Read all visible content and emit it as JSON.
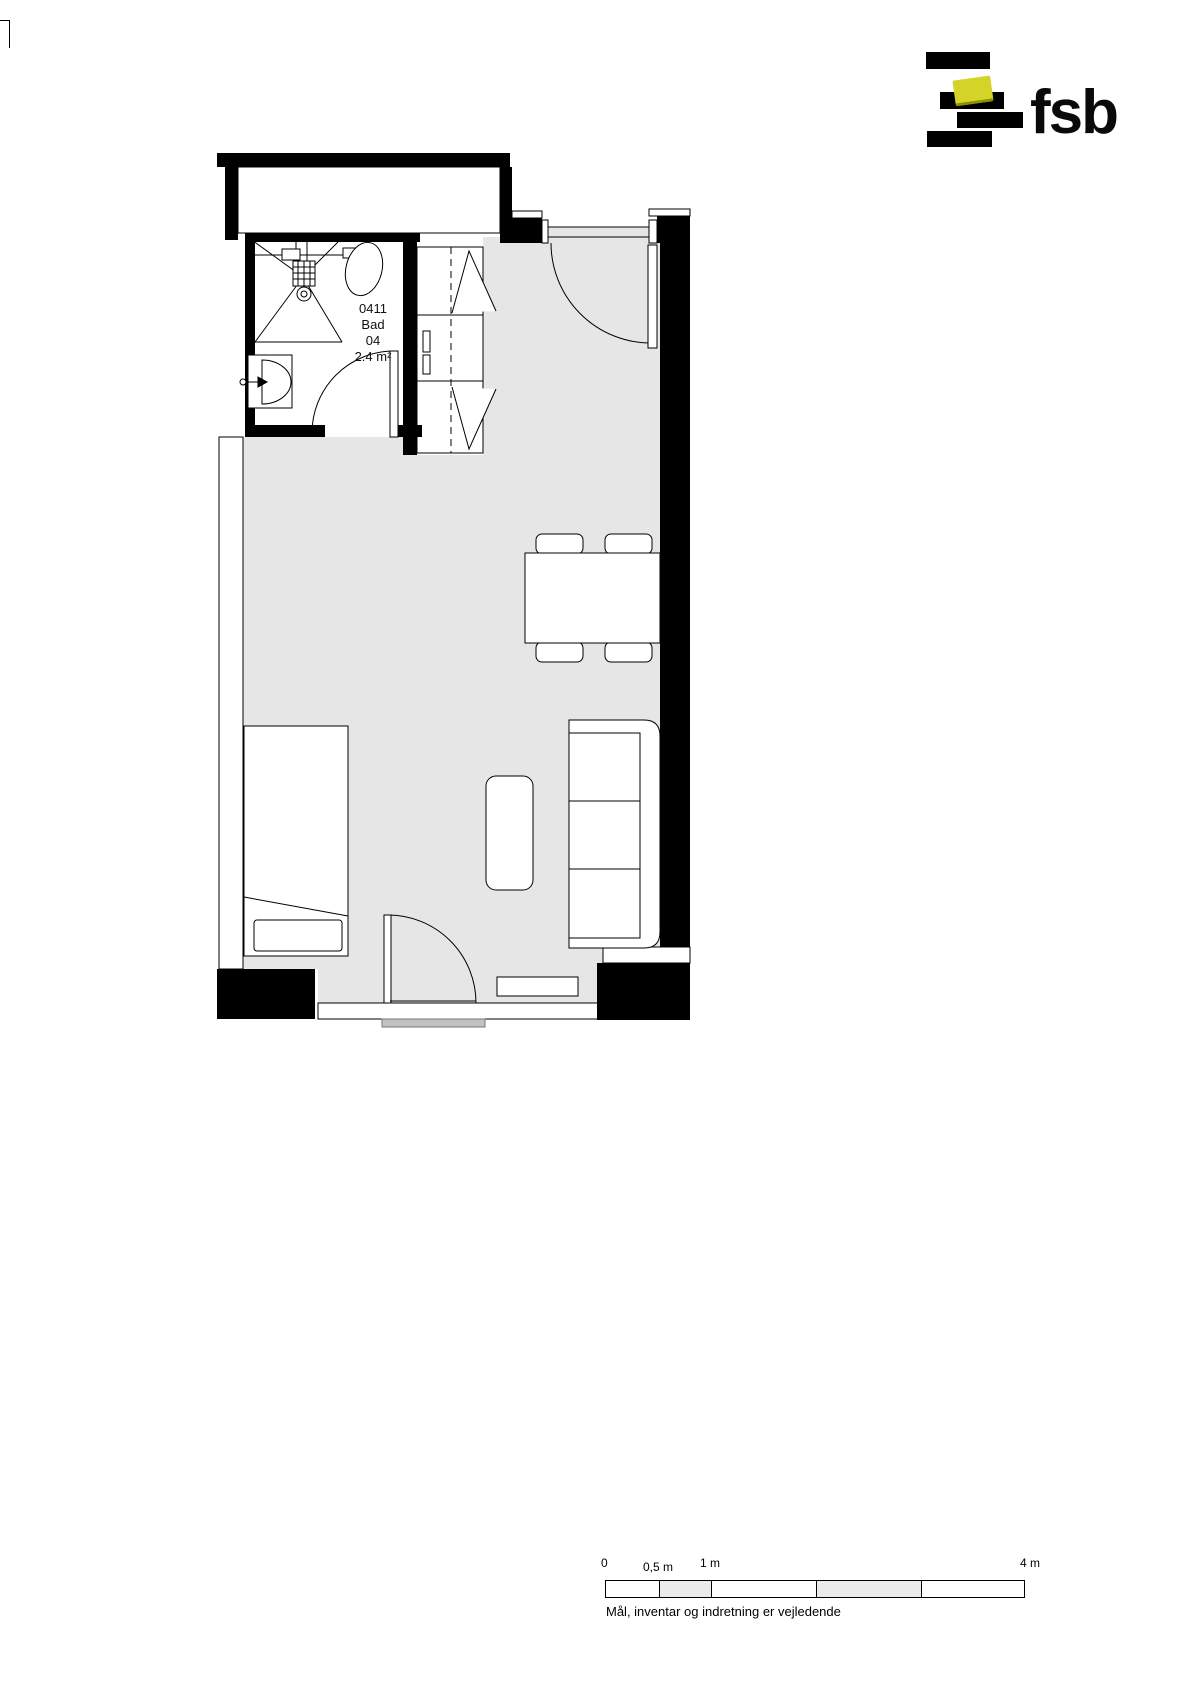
{
  "logo": {
    "text": "fsb",
    "bar_color": "#000000",
    "accent_color": "#d3d328"
  },
  "plan": {
    "room_label": {
      "number": "0411",
      "name": "Bad",
      "unit": "04",
      "area": "2.4 m²"
    },
    "colors": {
      "floor": "#e6e6e6",
      "wall": "#000000",
      "threshold": "#c2c2c2"
    }
  },
  "scale_bar": {
    "tick_labels": [
      {
        "text": "0"
      },
      {
        "text": "0,5 m"
      },
      {
        "text": "1 m"
      },
      {
        "text": "4 m"
      }
    ],
    "note": "Mål, inventar og indretning er vejledende"
  }
}
